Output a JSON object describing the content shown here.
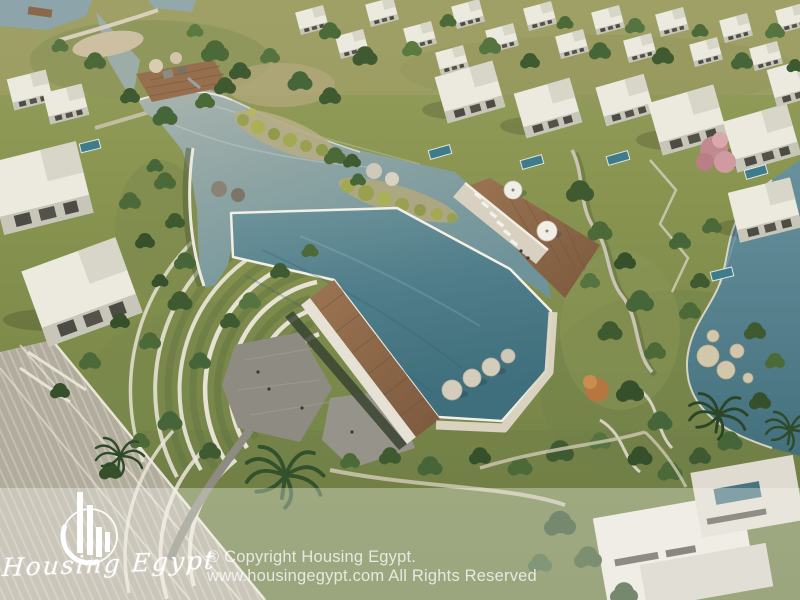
{
  "watermark": {
    "brand_name": "Housing Egypt",
    "logo_icon": "buildings-bars-in-circle-icon",
    "copyright_line1": "© Copyright Housing Egypt.",
    "copyright_line2": "www.housingegypt.com All Rights Reserved"
  },
  "scene": {
    "description": "Aerial 3D render of a residential compound: white modern villas surrounding a large organic-shaped lagoon pool with wooden decks, white umbrellas, sun loungers, floating pads, terraced gardens with curved white walls, palm trees and a winding canal.",
    "colors": {
      "pool_deep": "#47747f",
      "pool_shallow": "#8aa3a4",
      "canal": "#4f7d89",
      "grass": "#7b8a4f",
      "wood_deck": "#8b674a",
      "building_white": "#eceadf",
      "sand_path": "#cfc5ab",
      "overlay_tint": "rgba(252,251,247,0.33)",
      "watermark_text": "rgba(255,255,255,0.75)"
    }
  }
}
